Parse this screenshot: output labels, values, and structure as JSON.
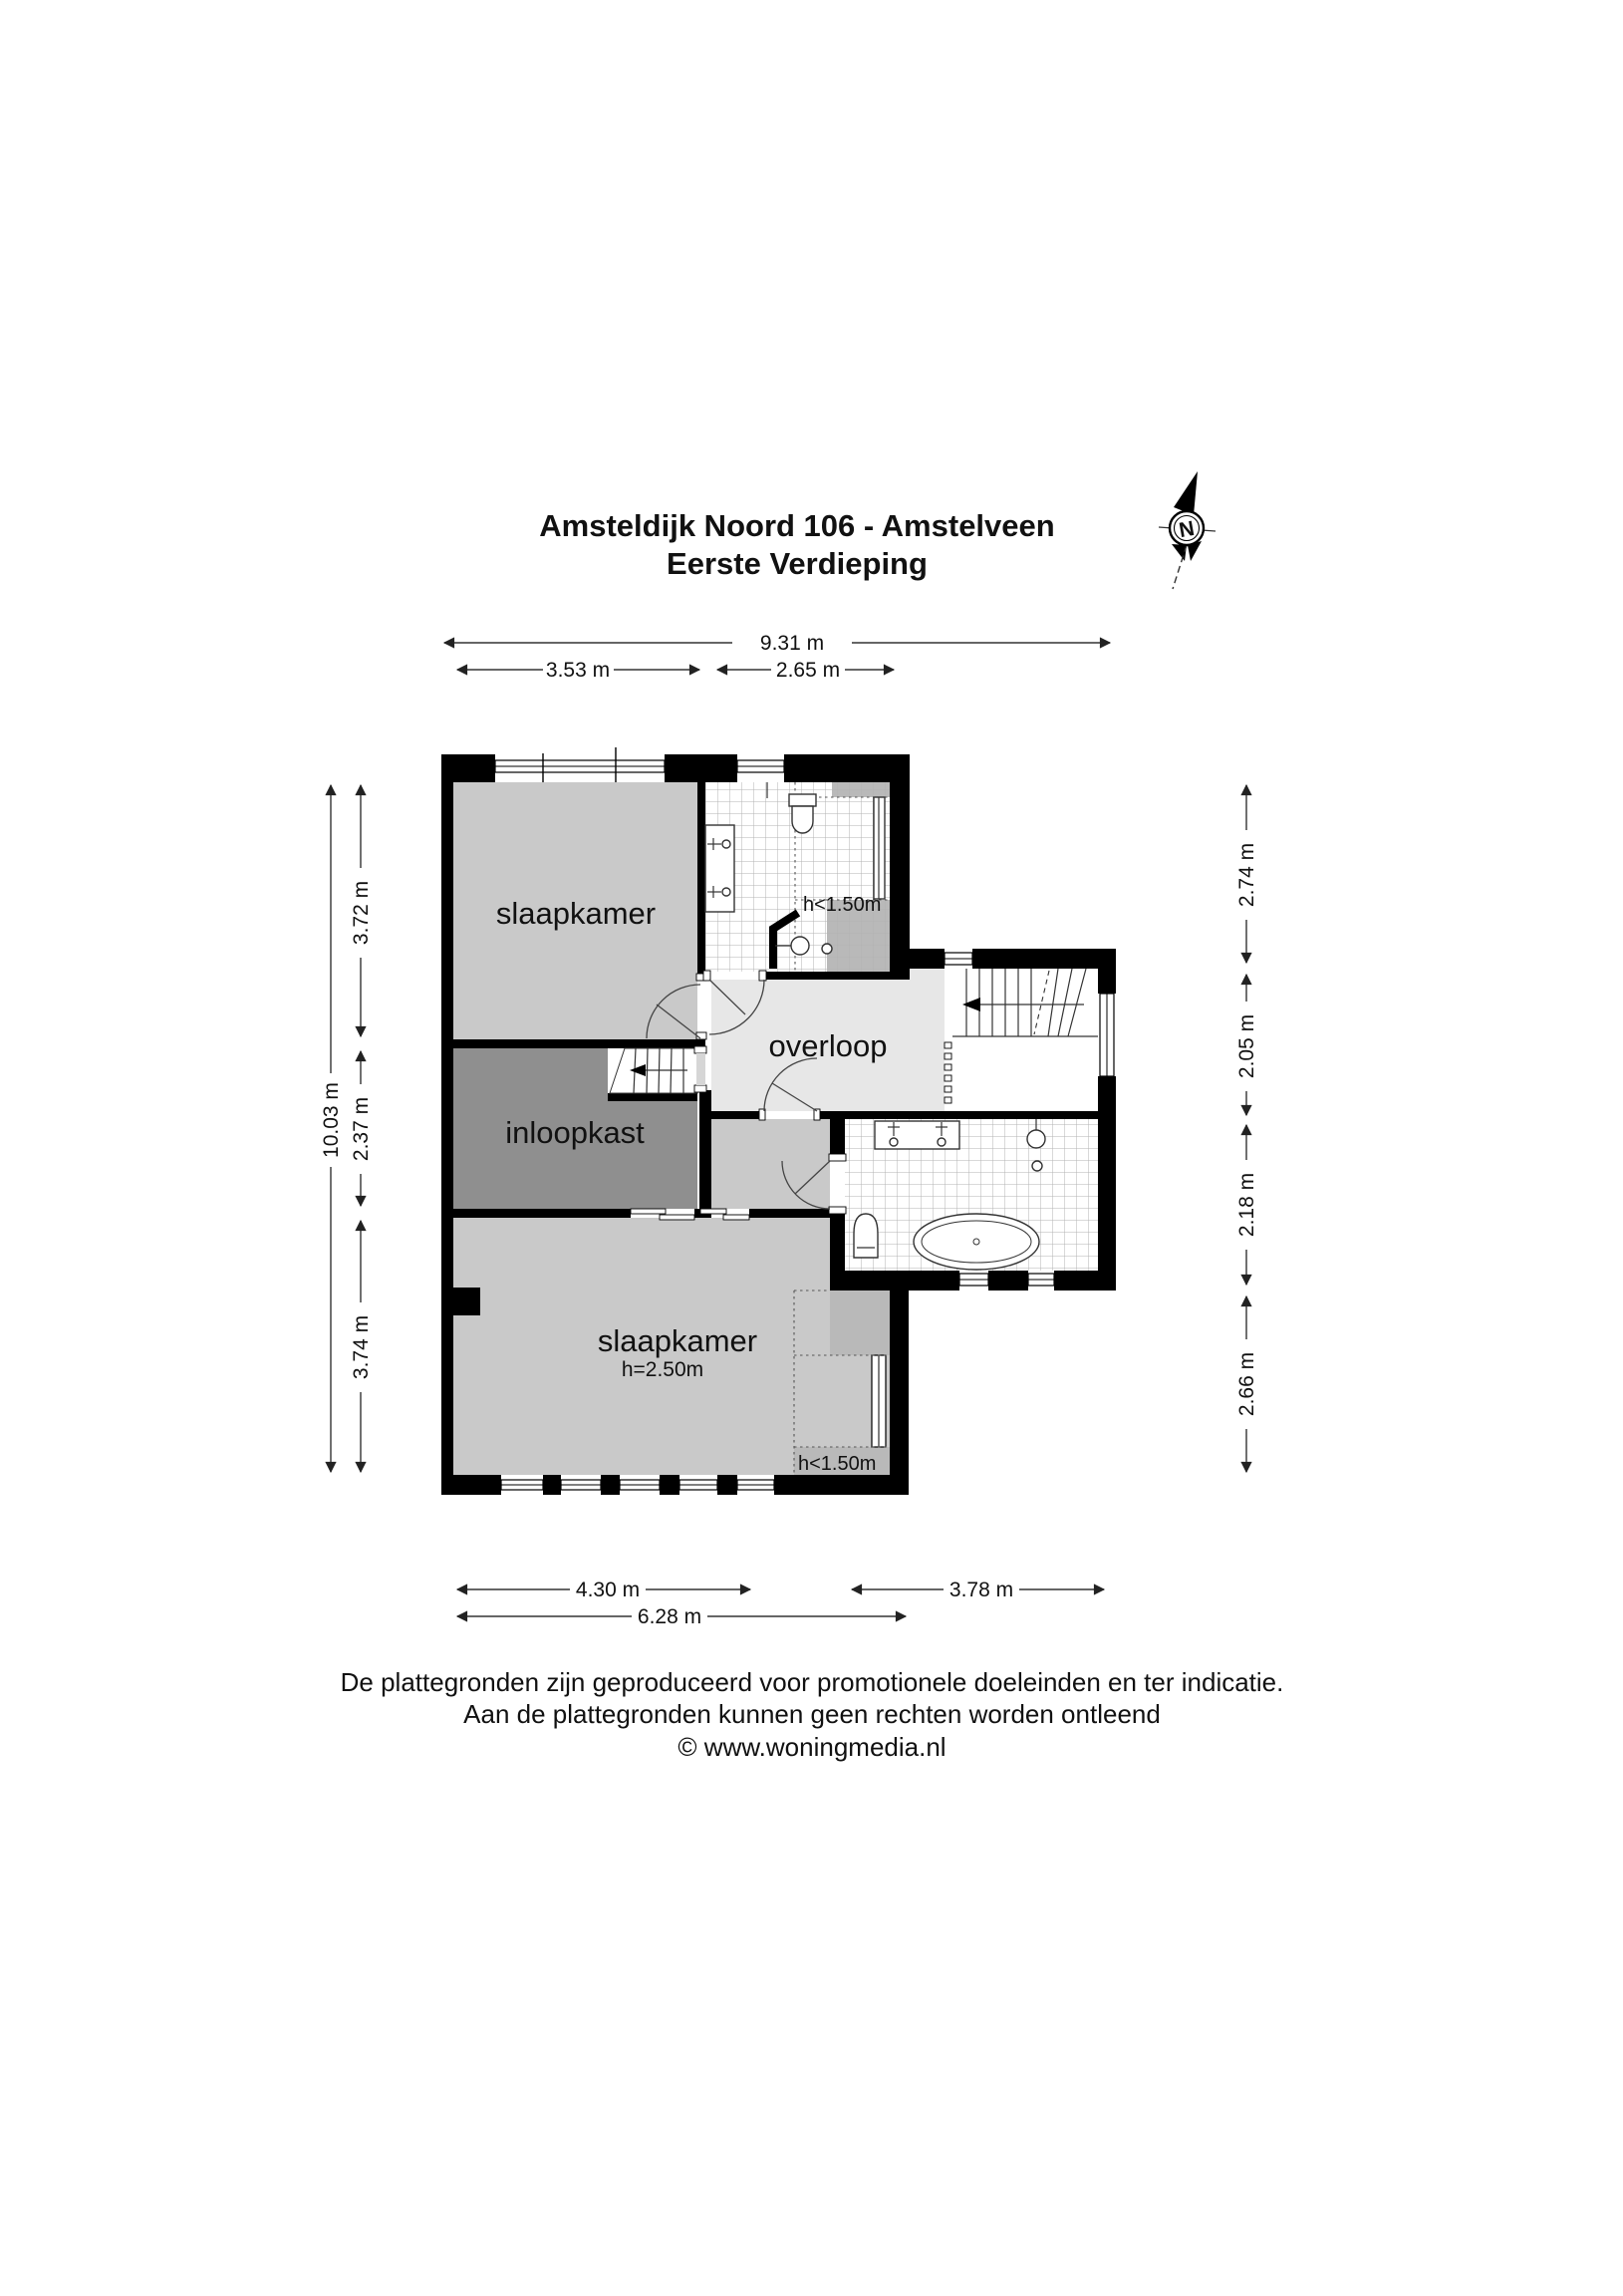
{
  "title": {
    "line1": "Amsteldijk Noord 106 - Amstelveen",
    "line2": "Eerste Verdieping"
  },
  "compass": {
    "north_label": "N"
  },
  "rooms": {
    "bedroom_top": {
      "label": "slaapkamer"
    },
    "bathroom_top": {
      "low_ceiling_label": "h<1.50m"
    },
    "walk_in_closet": {
      "label": "inloopkast"
    },
    "landing": {
      "label": "overloop"
    },
    "bedroom_bottom": {
      "label": "slaapkamer",
      "ceiling_label": "h=2.50m",
      "low_ceiling_label": "h<1.50m"
    }
  },
  "dimensions": {
    "top": {
      "total": "9.31 m",
      "left": "3.53 m",
      "right": "2.65 m"
    },
    "bottom": {
      "left": "4.30 m",
      "right": "3.78 m",
      "total": "6.28 m"
    },
    "left": {
      "total": "10.03 m",
      "top": "3.72 m",
      "middle": "2.37 m",
      "bottom": "3.74 m"
    },
    "right": {
      "top": "2.74 m",
      "upper_middle": "2.05 m",
      "lower_middle": "2.18 m",
      "bottom": "2.66 m"
    }
  },
  "footer": {
    "line1": "De plattegronden zijn geproduceerd voor promotionele doeleinden en ter indicatie.",
    "line2": "Aan de plattegronden kunnen geen rechten worden ontleend",
    "line3": "© www.woningmedia.nl"
  },
  "colors": {
    "wall": "#000000",
    "room_fill": "#c9c9c9",
    "closet_fill": "#8f8f8f",
    "landing_fill": "#e7e7e7",
    "low_ceiling_fill": "#b9b9b9",
    "tile_line": "#b3b3b3"
  }
}
